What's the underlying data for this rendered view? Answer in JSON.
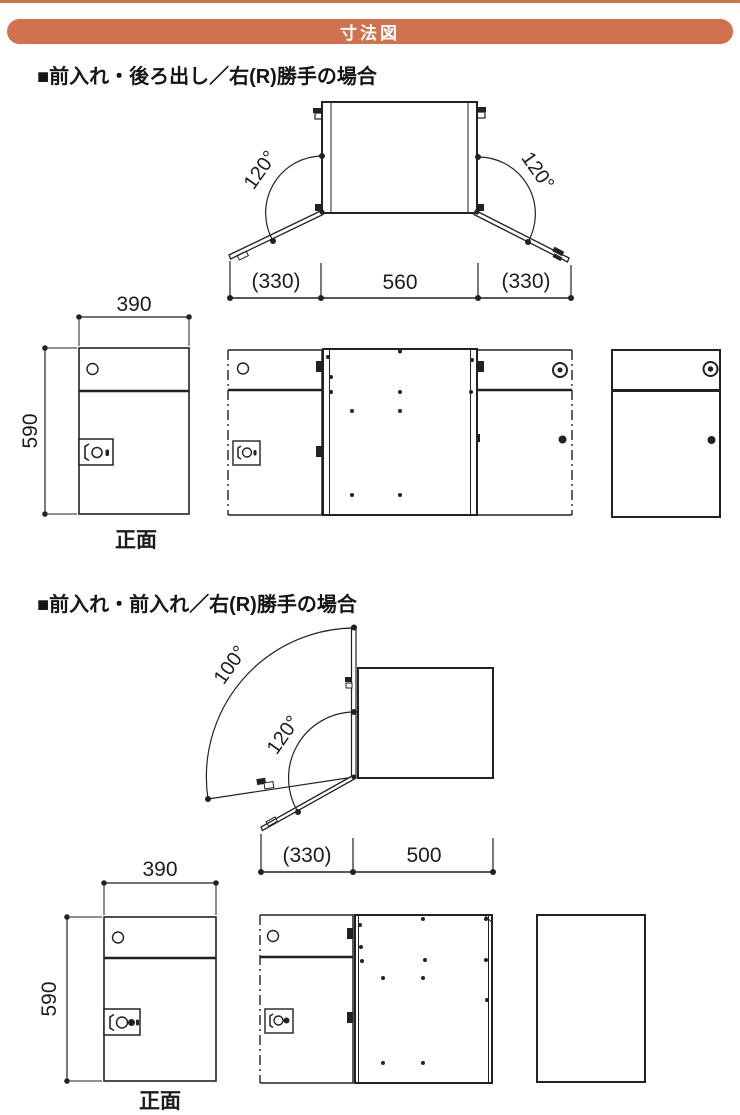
{
  "header": {
    "title": "寸法図"
  },
  "colors": {
    "accent": "#d2714e",
    "line": "#222222"
  },
  "sections": [
    {
      "title": "■前入れ・後ろ出し／右(R)勝手の場合",
      "top_view": {
        "left_angle": "120°",
        "right_angle": "120°",
        "dim_left": "(330)",
        "dim_center": "560",
        "dim_right": "(330)"
      },
      "front_view": {
        "width": "390",
        "height": "590",
        "caption": "正面"
      }
    },
    {
      "title": "■前入れ・前入れ／右(R)勝手の場合",
      "top_view": {
        "outer_angle": "100°",
        "inner_angle": "120°",
        "dim_left": "(330)",
        "dim_center": "500"
      },
      "front_view": {
        "width": "390",
        "height": "590",
        "caption": "正面"
      }
    }
  ]
}
